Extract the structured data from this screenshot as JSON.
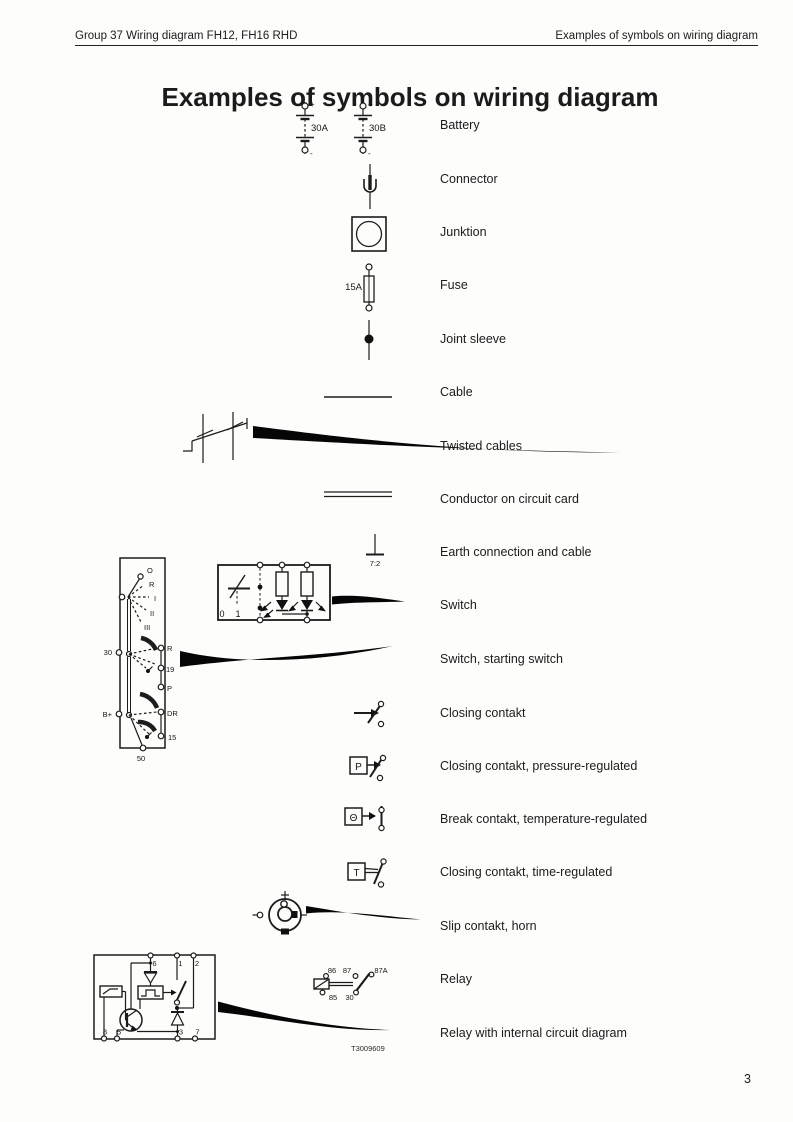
{
  "header": {
    "left": "Group 37 Wiring diagram FH12, FH16 RHD",
    "right": "Examples of symbols on wiring diagram"
  },
  "title": "Examples of symbols on wiring diagram",
  "footer": {
    "figure_ref": "T3009609",
    "page_number": "3"
  },
  "symbols": {
    "battery": {
      "label": "Battery",
      "id_a": "30A",
      "id_b": "30B",
      "plus": "+",
      "minus": "-"
    },
    "connector": {
      "label": "Connector"
    },
    "junction": {
      "label": "Junktion"
    },
    "fuse": {
      "label": "Fuse",
      "rating": "15A"
    },
    "joint_sleeve": {
      "label": "Joint sleeve"
    },
    "cable": {
      "label": "Cable"
    },
    "twisted_cables": {
      "label": "Twisted cables"
    },
    "conductor": {
      "label": "Conductor on circuit card"
    },
    "earth": {
      "label": "Earth connection and cable",
      "ref": "7:2"
    },
    "switch": {
      "label": "Switch",
      "pos0": "0",
      "pos1": "1"
    },
    "starting_switch": {
      "label": "Switch, starting switch",
      "pos_o": "O",
      "pos_r": "R",
      "pos_i": "I",
      "pos_ii": "II",
      "pos_iii": "III",
      "t30": "30",
      "tr": "R",
      "t19": "19",
      "tp": "P",
      "tb": "B+",
      "tdr": "DR",
      "t15": "15",
      "t50": "50"
    },
    "closing_contact": {
      "label": "Closing contakt"
    },
    "closing_contact_pressure": {
      "label": "Closing contakt, pressure-regulated",
      "letter": "P"
    },
    "break_contact_temperature": {
      "label": "Break contakt, temperature-regulated",
      "letter": "Θ"
    },
    "closing_contact_time": {
      "label": "Closing contakt, time-regulated",
      "letter": "T"
    },
    "slip_contact": {
      "label": "Slip contakt, horn"
    },
    "relay": {
      "label": "Relay",
      "t86": "86",
      "t87": "87",
      "t87a": "87A",
      "t85": "85",
      "t30": "30"
    },
    "relay_internal": {
      "label": "Relay with internal circuit diagram",
      "t6": "6",
      "t1": "1",
      "t2": "2",
      "t8": "8",
      "t5": "5",
      "t3": "3",
      "t7": "7"
    }
  }
}
